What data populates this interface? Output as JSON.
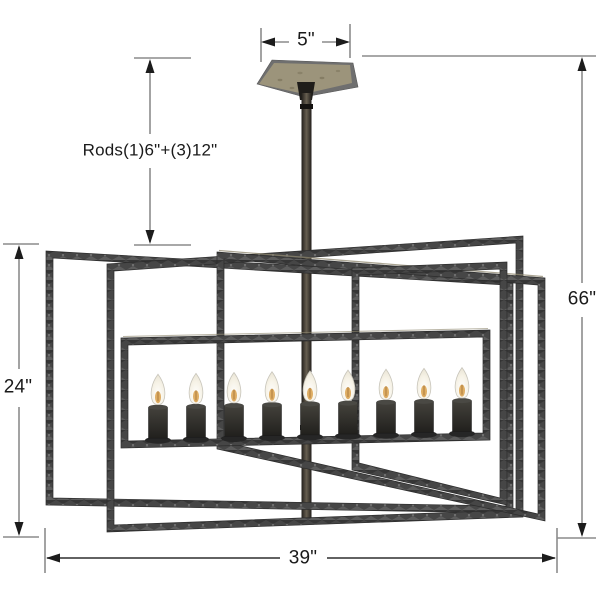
{
  "figure": {
    "type": "product-dimension-diagram",
    "subject": "linear cage chandelier with candelabra bulbs",
    "lights_count": 9,
    "labels": {
      "canopy_width": "5\"",
      "rods": "Rods(1)6\"+(3)12\"",
      "overall_height": "66\"",
      "cage_height": "24\"",
      "cage_width": "39\""
    },
    "colors": {
      "background": "#ffffff",
      "frame_iron": "#464646",
      "frame_iron_light": "#5d5d5d",
      "frame_iron_dark": "#333333",
      "dimension_line": "#8c8c8c",
      "dimension_line_dark": "#2e2e2e",
      "arrow": "#1c1c1c",
      "label_text": "#1a1a1a",
      "canopy_top": "#9c947b",
      "canopy_side": "#6f6f6f",
      "stem": "#4a443c",
      "bulb": "#f6f2e6",
      "bulb_glow": "#d9a04a",
      "candle_sleeve": "#2b2a27"
    }
  }
}
